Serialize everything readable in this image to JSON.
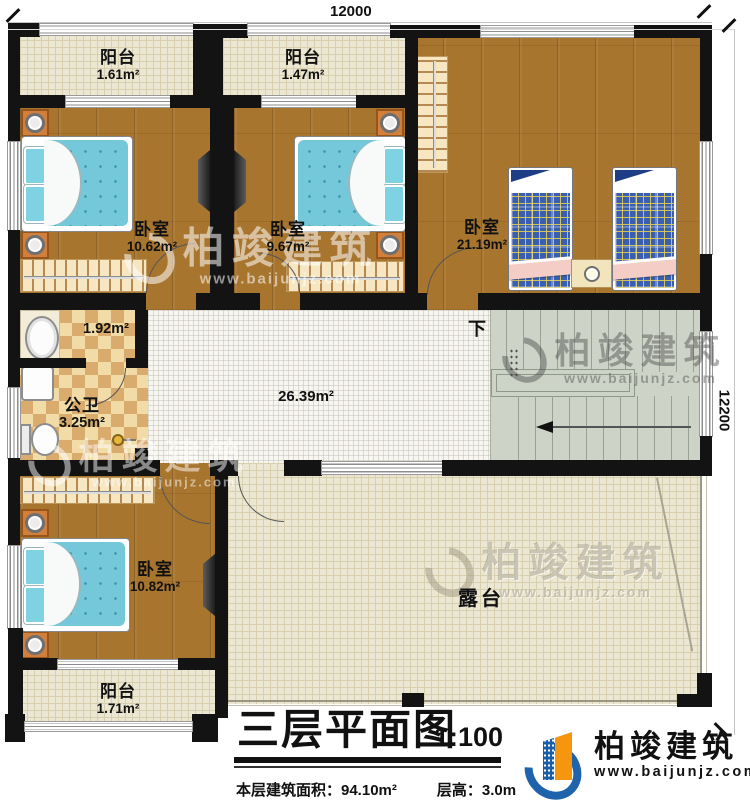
{
  "dimensions": {
    "top": "12000",
    "right": "12200"
  },
  "rooms": {
    "balcony_top_left": {
      "name": "阳台",
      "area": "1.61m²"
    },
    "balcony_top_mid": {
      "name": "阳台",
      "area": "1.47m²"
    },
    "bedroom_top_left": {
      "name": "卧室",
      "area": "10.62m²"
    },
    "bedroom_top_mid": {
      "name": "卧室",
      "area": "9.67m²"
    },
    "bedroom_right": {
      "name": "卧室",
      "area": "21.19m²"
    },
    "vanity": {
      "area": "1.92m²"
    },
    "bathroom": {
      "name": "公卫",
      "area": "3.25m²"
    },
    "hall": {
      "area": "26.39m²"
    },
    "bedroom_bottom_left": {
      "name": "卧室",
      "area": "10.82m²"
    },
    "balcony_bottom": {
      "name": "阳台",
      "area": "1.71m²"
    },
    "terrace": {
      "name": "露台"
    }
  },
  "stairs": {
    "down_label": "下"
  },
  "title_block": {
    "title": "三层平面图",
    "scale": "1:100",
    "floor_area": "本层建筑面积：94.10m²",
    "floor_height": "层高：3.0m"
  },
  "brand": {
    "name": "柏竣建筑",
    "site": "www.baijunjz.com"
  }
}
